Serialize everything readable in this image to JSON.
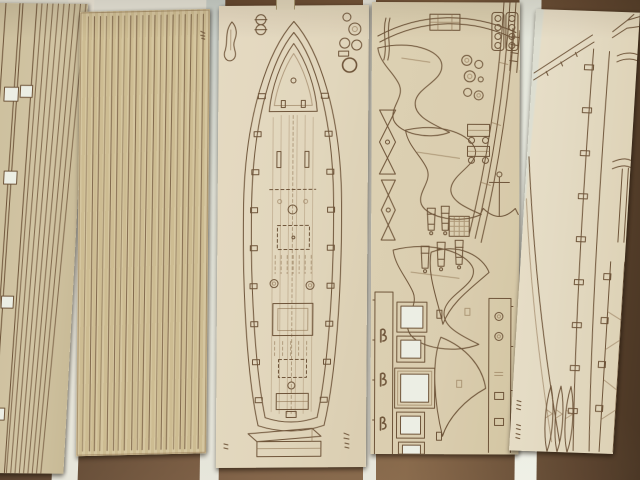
{
  "scene": {
    "description": "Photograph of five tan laser-cut plywood model ship kit sheets lying side by side on a dark reddish-brown wooden table, bright backing paper visible in the gaps between sheets",
    "surface": "dark brown wooden table",
    "lighting": "soft indoor light, slight vignette, mild blur"
  },
  "colors": {
    "table": "#69492e",
    "table_dark": "#4a3421",
    "table_light": "#7d5b3b",
    "gap_backing": "#e9e8dc",
    "line": "#6f5336",
    "line_soft": "#8a6b47",
    "cutout": "#eef0e6",
    "sheet1": "#d3c5a2",
    "sheet2": "#d8c79e",
    "sheet3": "#e4d8bc",
    "sheet4": "#dccfae",
    "sheet5": "#e7ddc4"
  },
  "sheets": [
    {
      "id": "sheet-planking-strips-a",
      "label": "side planking strips, two wide strips with square gunport cutouts",
      "strip_count": 9,
      "square_cutouts": 5
    },
    {
      "id": "sheet-planking-strips-b",
      "label": "deck planking strip sheet",
      "plank_count": 20
    },
    {
      "id": "sheet-deck",
      "label": "main deck with etched hatches, mast holes and bulwark notches; loose fittings and transom part",
      "notch_pairs": 9
    },
    {
      "id": "sheet-parts",
      "label": "bulkhead frames, cannons, anchor, gratings, gun carriage, window frames with cut-through openings"
    },
    {
      "id": "sheet-keel",
      "label": "notched keel pieces, davits, sheer curves and lens-shaped blades",
      "keel_tabs": 9
    }
  ],
  "markings": {
    "note": "tiny illegible etched maker marks on sheet corners"
  }
}
